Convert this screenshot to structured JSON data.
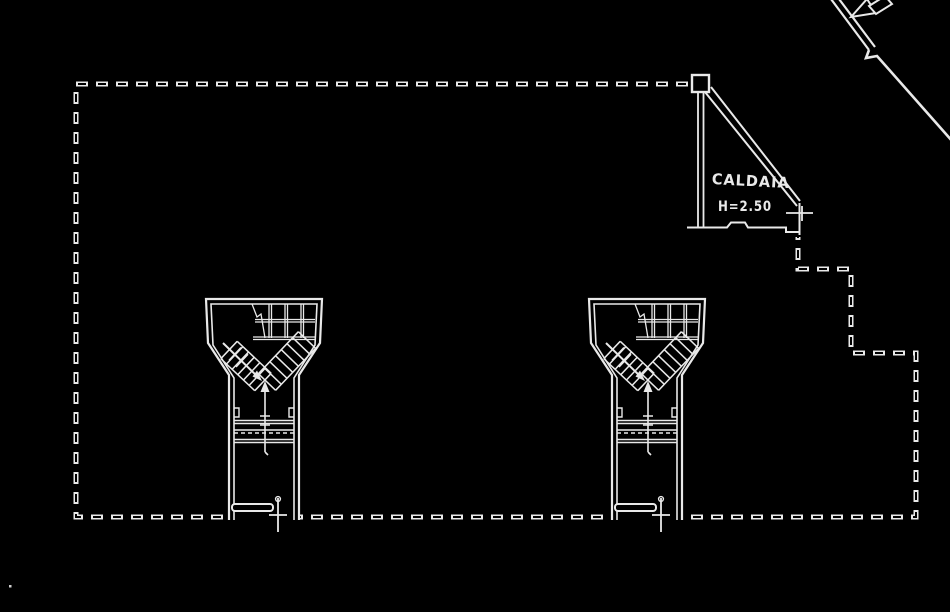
{
  "page": {
    "background": "#000000",
    "line_color": "#e9e9e9"
  },
  "drawing": {
    "kind": "scanned basement floor plan, white line-work on black",
    "labels": {
      "boiler_room": "CALDAIA",
      "boiler_height": "H=2.50"
    },
    "elements": {
      "site_boundary": "stepped dashed boundary outline",
      "stairwell_left": "funnel-shaped stairwell with twin stair flights",
      "stairwell_right": "funnel-shaped stairwell with twin stair flights",
      "boiler_enclosure": "triangular CALDAIA enclosure hanging from top boundary",
      "ramp_line": "diagonal line entering from top-right",
      "direction_arrow": "solid arrow pointing down-left along ramp line"
    }
  }
}
